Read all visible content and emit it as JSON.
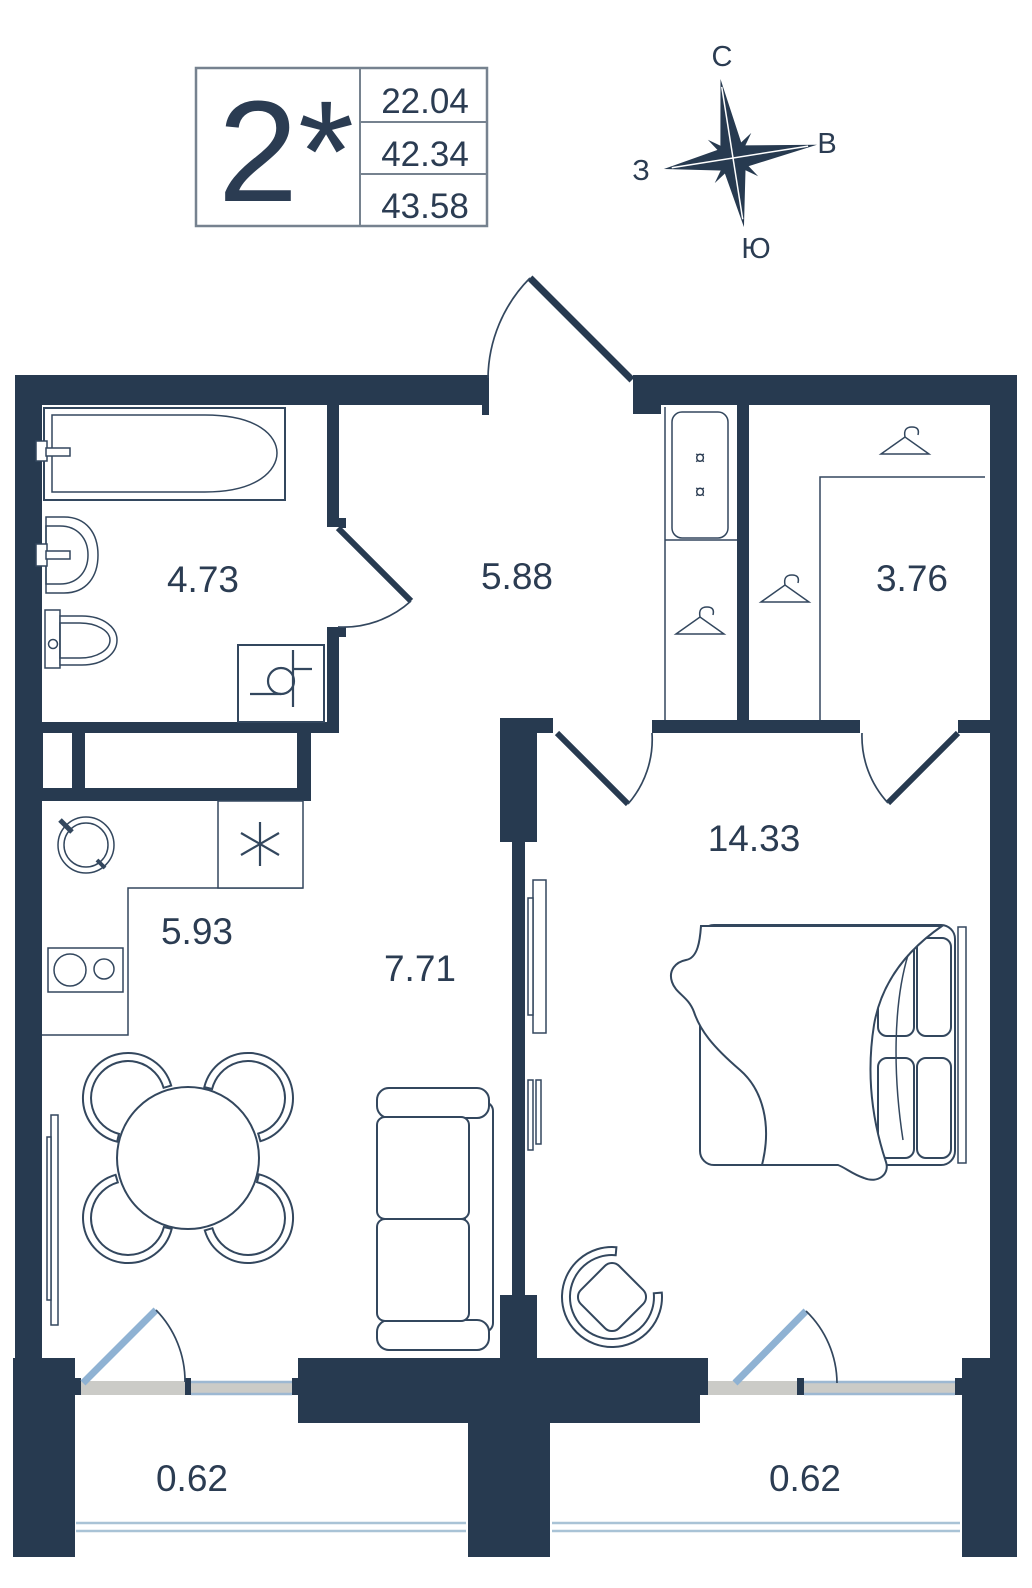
{
  "legend": {
    "type_label": "2*",
    "values": [
      "22.04",
      "42.34",
      "43.58"
    ]
  },
  "compass": {
    "north": "С",
    "east": "В",
    "west": "З",
    "south": "Ю"
  },
  "rooms": {
    "bathroom": {
      "area": "4.73"
    },
    "hallway": {
      "area": "5.88"
    },
    "wardrobe": {
      "area": "3.76"
    },
    "kitchen": {
      "area": "5.93"
    },
    "living": {
      "area": "7.71"
    },
    "bedroom": {
      "area": "14.33"
    },
    "balcony_left": {
      "area": "0.62"
    },
    "balcony_right": {
      "area": "0.62"
    }
  },
  "symbols": {
    "cabinet": "¤"
  },
  "colors": {
    "background": "#ffffff",
    "wall": "#273a50",
    "line": "#33475e",
    "text": "#2b3c52",
    "door": "#8fb2d3",
    "threshold": "#cbcbc7",
    "window_glass": "#9db8d2",
    "rail": "#a9c3d6",
    "legend_border": "#76828f"
  }
}
